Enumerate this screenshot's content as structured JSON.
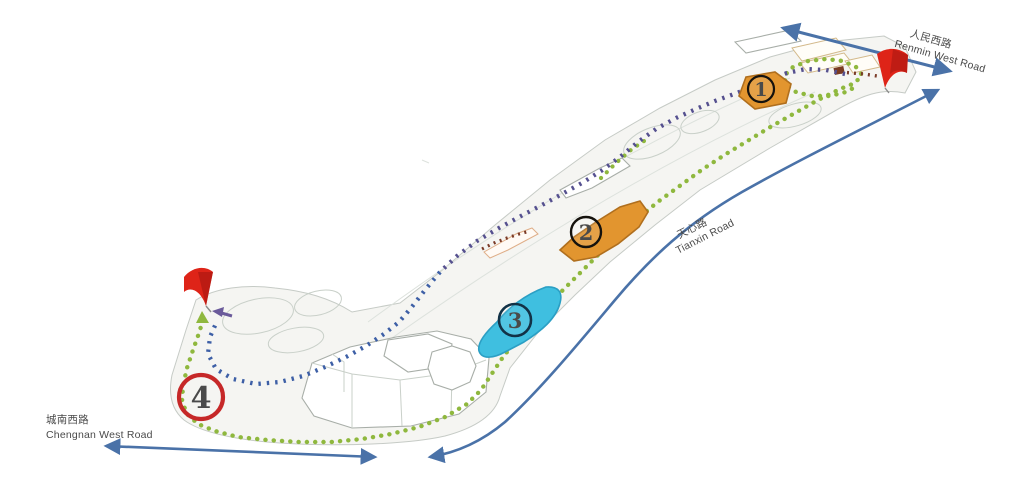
{
  "map": {
    "roads": {
      "renmin": {
        "zh": "人民西路",
        "en": "Renmin West Road"
      },
      "tianxin": {
        "zh": "天心路",
        "en": "Tianxin Road"
      },
      "chengnan": {
        "zh": "城南西路",
        "en": "Chengnan West Road"
      }
    },
    "markers": {
      "m1": {
        "label": "1"
      },
      "m2": {
        "label": "2"
      },
      "m3": {
        "label": "3"
      },
      "m4": {
        "label": "4"
      }
    },
    "icons": {
      "east_flag": "red-flag",
      "west_flag": "red-flag"
    },
    "colors": {
      "route_purple": "#55508F",
      "route_blue": "#3D5FA6",
      "route_green": "#8FB83E",
      "route_brown": "#7A3B28",
      "road_blue": "#4A72A8",
      "highlight_orange": "#E2952F",
      "highlight_orange_edge": "#B06F1E",
      "highlight_cyan": "#3FBFE0",
      "highlight_cyan_edge": "#2B9FC4",
      "marker_red": "#C62828",
      "flag_red": "#DE2418"
    }
  }
}
